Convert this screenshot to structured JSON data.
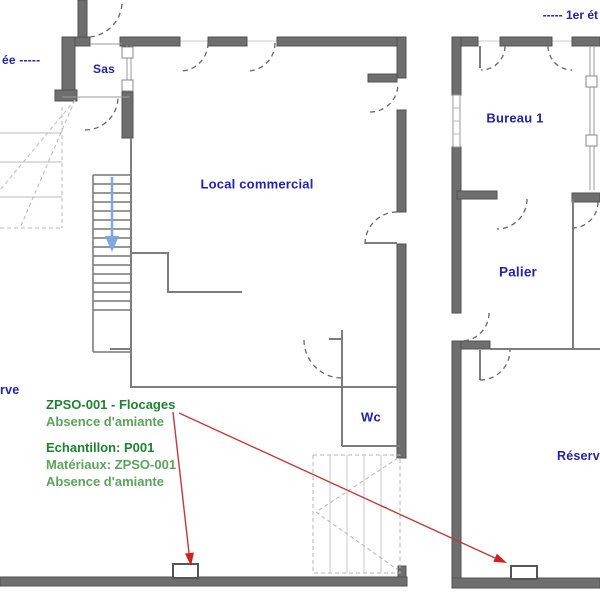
{
  "title_labels": {
    "ground_floor_fragment": "ée -----",
    "first_floor_fragment": "----- 1er ét"
  },
  "ground_floor": {
    "rooms": {
      "sas": "Sas",
      "local_commercial": "Local commercial",
      "wc": "Wc",
      "reserve_fragment": "rve"
    }
  },
  "first_floor": {
    "rooms": {
      "bureau1": "Bureau 1",
      "palier": "Palier",
      "reserve_fragment": "Réserv"
    }
  },
  "annotations": {
    "zone": {
      "title": "ZPSO-001 - Flocages",
      "result": "Absence d'amiante"
    },
    "sample": {
      "title": "Echantillon: P001",
      "material": "Matériaux: ZPSO-001",
      "result": "Absence d'amiante"
    }
  },
  "colors": {
    "room_label": "#2323a8",
    "annotation_title": "#1f8132",
    "annotation_body": "#5da35c",
    "arrow": "#bf3b3b",
    "wall": "#6e6e6e",
    "stair_arrow": "#7da7e0"
  }
}
